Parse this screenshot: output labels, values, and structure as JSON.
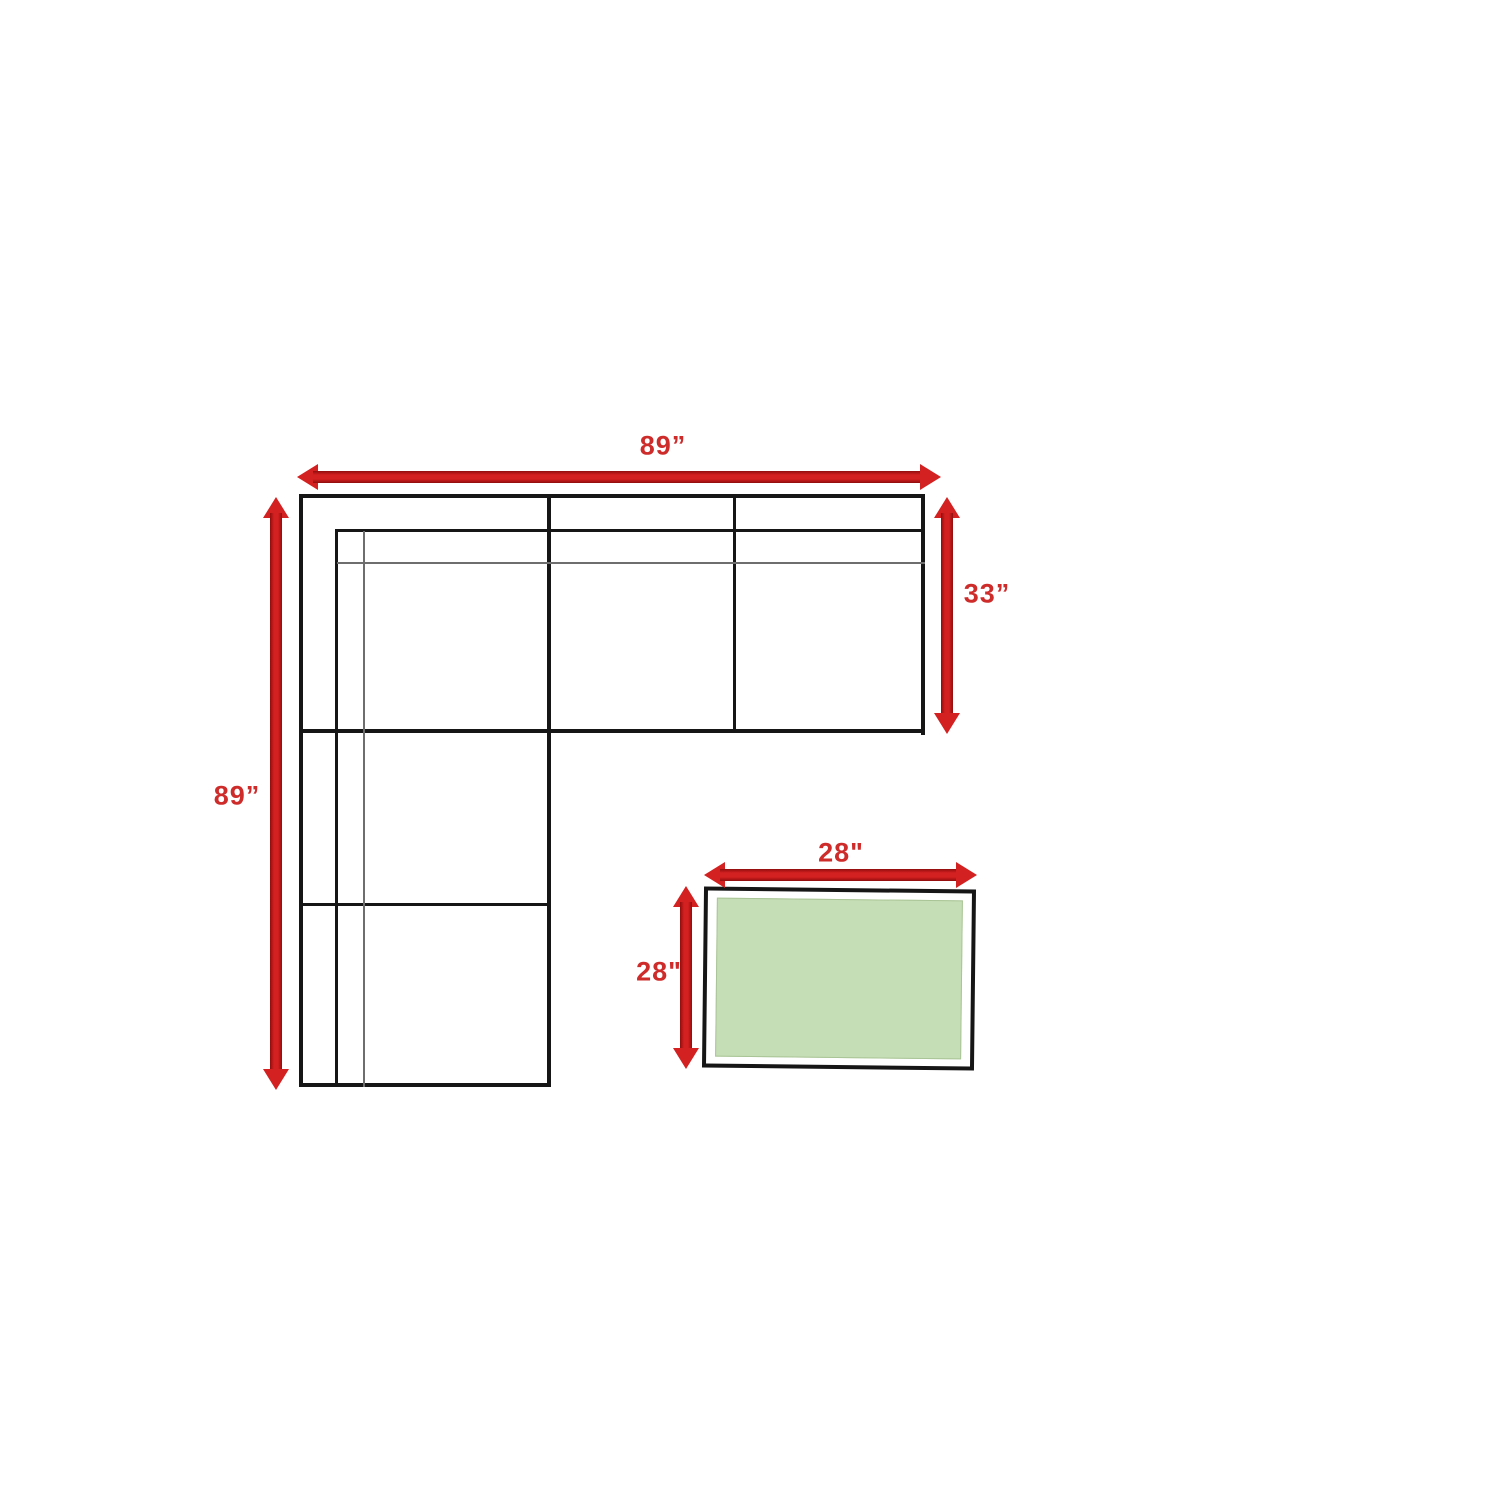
{
  "labels": {
    "sofa_width": "89”",
    "sofa_height": "89”",
    "sofa_depth": "33”",
    "table_width": "28\"",
    "table_depth": "28\""
  },
  "dimensions_inches": {
    "sofa_width": 89,
    "sofa_height": 89,
    "sofa_depth": 33,
    "table_width": 28,
    "table_depth": 28
  },
  "colors": {
    "arrow_red": "#d32020",
    "label_red": "#ce2b2b",
    "line_black": "#161616",
    "thin_line_gray": "#6e6e6e",
    "table_green": "#c6deb5",
    "table_green_border": "#a9c496",
    "background": "#ffffff"
  }
}
